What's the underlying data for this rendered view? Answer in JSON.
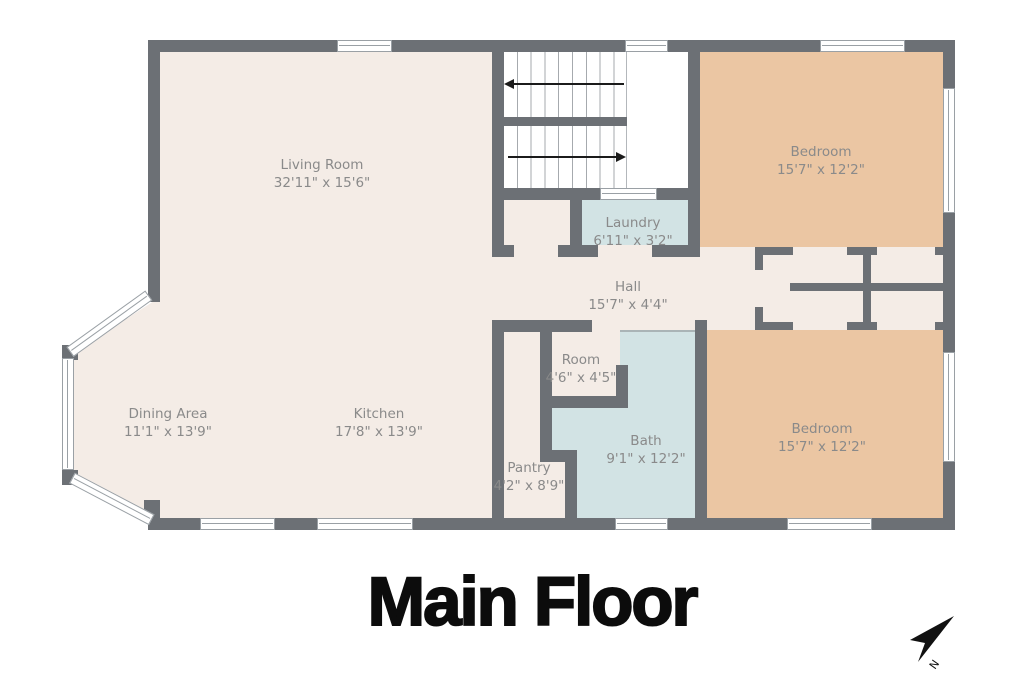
{
  "title": "Main Floor",
  "compass": {
    "label": "N"
  },
  "rooms": [
    {
      "id": "living-room",
      "name": "Living Room",
      "dims": "32'11\" x 15'6\""
    },
    {
      "id": "bedroom-top",
      "name": "Bedroom",
      "dims": "15'7\" x 12'2\""
    },
    {
      "id": "laundry",
      "name": "Laundry",
      "dims": "6'11\" x 3'2\""
    },
    {
      "id": "hall",
      "name": "Hall",
      "dims": "15'7\" x 4'4\""
    },
    {
      "id": "dining-area",
      "name": "Dining Area",
      "dims": "11'1\" x 13'9\""
    },
    {
      "id": "kitchen",
      "name": "Kitchen",
      "dims": "17'8\" x 13'9\""
    },
    {
      "id": "room",
      "name": "Room",
      "dims": "4'6\" x 4'5\""
    },
    {
      "id": "bath",
      "name": "Bath",
      "dims": "9'1\" x 12'2\""
    },
    {
      "id": "pantry",
      "name": "Pantry",
      "dims": "4'2\" x 8'9\""
    },
    {
      "id": "bedroom-bottom",
      "name": "Bedroom",
      "dims": "15'7\" x 12'2\""
    }
  ],
  "colors": {
    "wall": "#6c7075",
    "room_cream": "#f4ece6",
    "bedroom_peach": "#ebc6a3",
    "wet_room_blue": "#d2e3e4",
    "label_gray": "#8a8a8a",
    "title_black": "#0c0c0c"
  }
}
